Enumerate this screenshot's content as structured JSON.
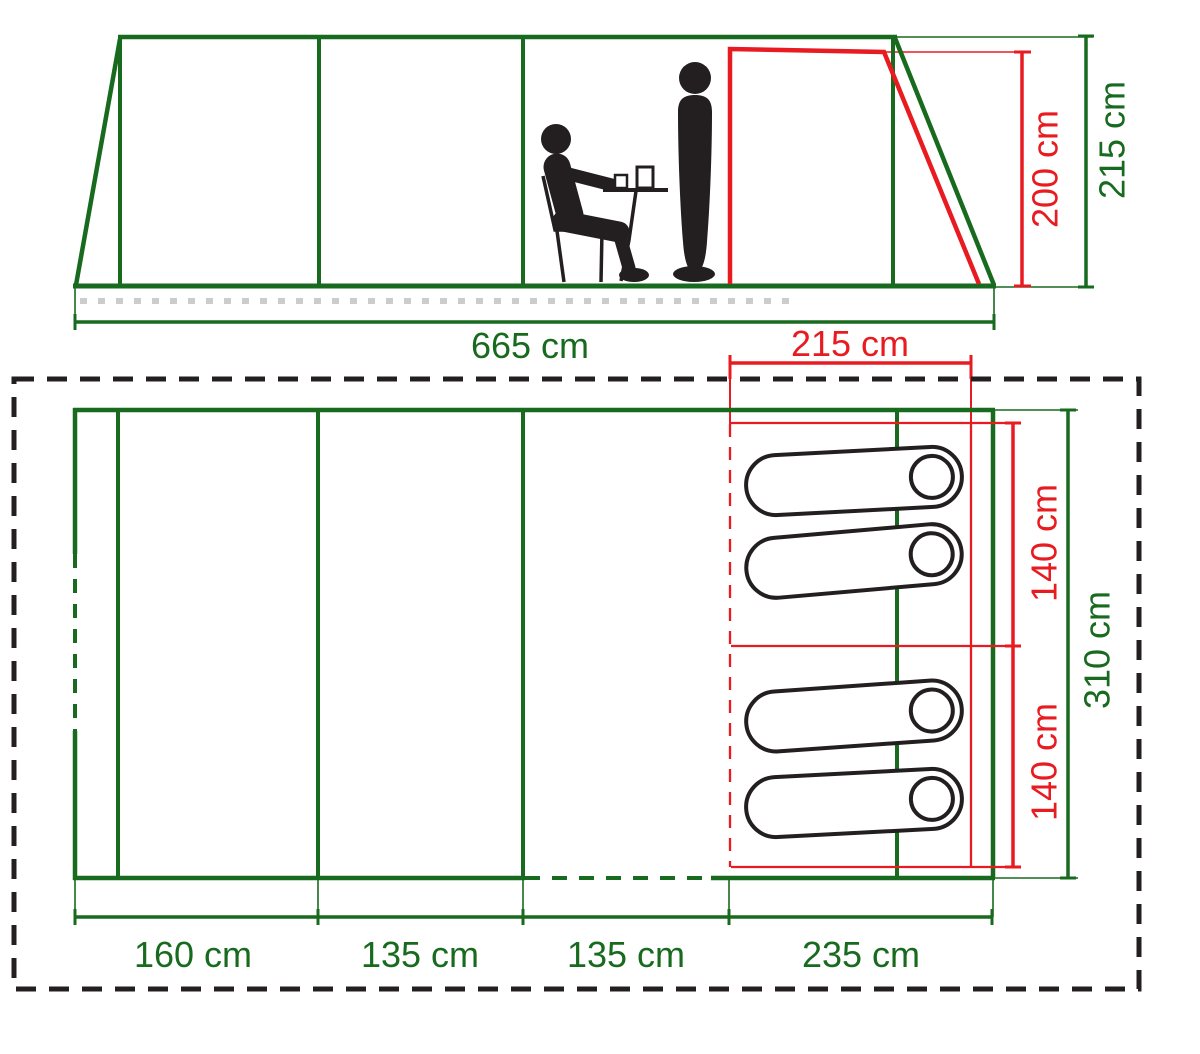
{
  "title": "Tent dimension diagram (side elevation and floor plan)",
  "colors": {
    "green": "#186A1E",
    "red": "#E81B20",
    "black": "#231F20",
    "ground_dash_gray": "#CCCCCC"
  },
  "side_view": {
    "length_label": "665 cm",
    "door_width_label": "215 cm",
    "door_height_label": "200 cm",
    "tent_height_label": "215 cm"
  },
  "floor_plan": {
    "bedroom_width_top_label": "140 cm",
    "bedroom_width_bottom_label": "140 cm",
    "tent_width_label": "310 cm",
    "section_labels": [
      "160 cm",
      "135 cm",
      "135 cm",
      "235 cm"
    ],
    "sleeping_bag_count": 4
  }
}
